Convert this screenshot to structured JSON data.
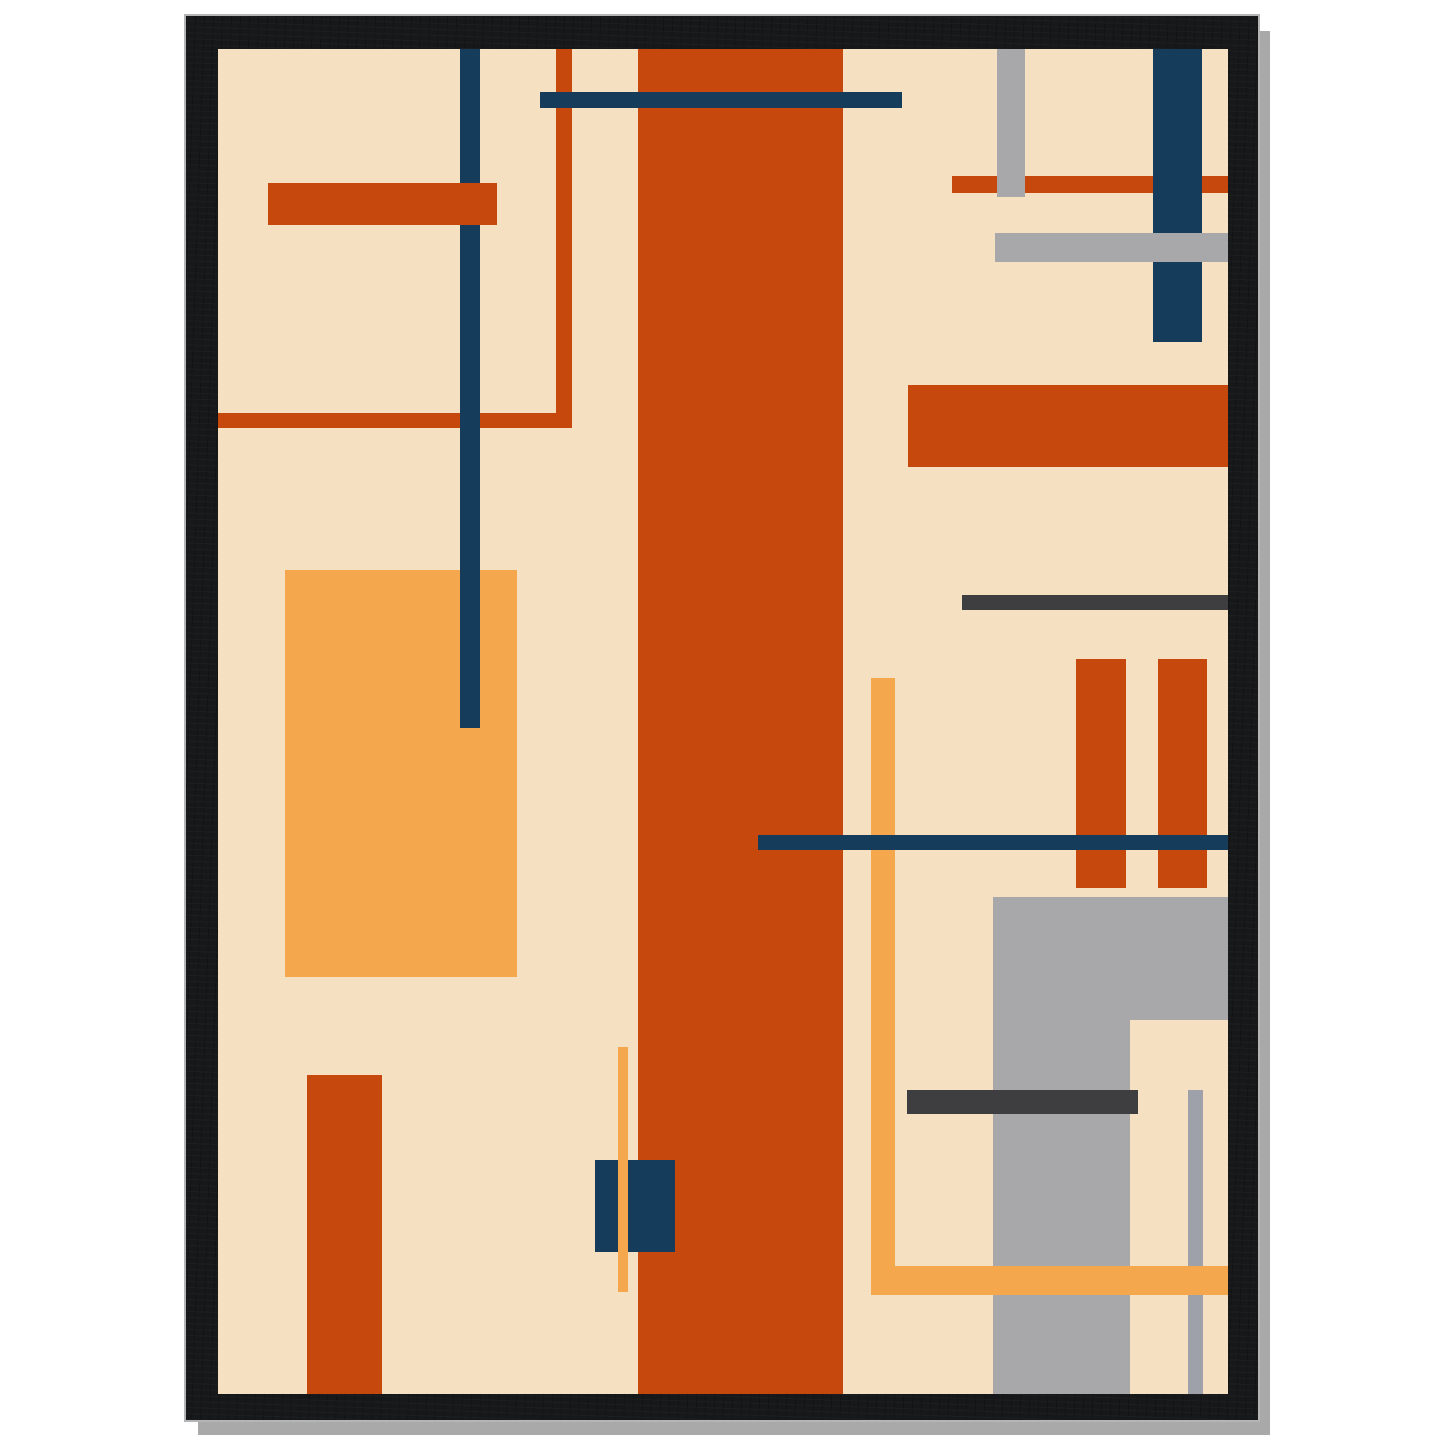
{
  "scene": {
    "background": "#ffffff",
    "description": "framed abstract geometric art poster mockup"
  },
  "palette": {
    "cream": "#F5E1C1",
    "rust": "#C6480D",
    "amber": "#F5A74D",
    "navy": "#163C5C",
    "gray": "#A8A8AA",
    "darkgray": "#3E3E40",
    "linegray": "#9EA1A9",
    "frame_black": "#17181A",
    "shadow_gray": "#A9A9A9",
    "outline_gray": "#B5B5B5"
  },
  "frame": {
    "x": 186,
    "y": 16,
    "width": 1072,
    "height": 1404,
    "border_top": 33,
    "border_right": 30,
    "border_bottom": 26,
    "border_left": 32,
    "shadow_offset_x": 12,
    "shadow_offset_y": 15
  },
  "art": {
    "width": 1010,
    "height": 1345,
    "background_color_key": "cream"
  },
  "shapes": [
    {
      "name": "amber-rect-left",
      "x": 67,
      "y": 521,
      "w": 232,
      "h": 407,
      "color": "amber",
      "z": 1
    },
    {
      "name": "rust-line-left-horizontal",
      "x": 0,
      "y": 364,
      "w": 354,
      "h": 15,
      "color": "rust",
      "z": 1
    },
    {
      "name": "rust-line-left-vertical",
      "x": 338,
      "y": 0,
      "w": 16,
      "h": 379,
      "color": "rust",
      "z": 1
    },
    {
      "name": "rust-stripe-center",
      "x": 420,
      "y": 0,
      "w": 205,
      "h": 1345,
      "color": "rust",
      "z": 1
    },
    {
      "name": "rust-rect-bottom-left",
      "x": 89,
      "y": 1026,
      "w": 75,
      "h": 319,
      "color": "rust",
      "z": 1
    },
    {
      "name": "rust-line-top-right",
      "x": 734,
      "y": 127,
      "w": 276,
      "h": 17,
      "color": "rust",
      "z": 1
    },
    {
      "name": "rust-bar-right",
      "x": 690,
      "y": 336,
      "w": 320,
      "h": 82,
      "color": "rust",
      "z": 1
    },
    {
      "name": "darkgray-line-right",
      "x": 744,
      "y": 546,
      "w": 266,
      "h": 15,
      "color": "darkgray",
      "z": 1
    },
    {
      "name": "gray-rect-bottom-right",
      "x": 775,
      "y": 848,
      "w": 235,
      "h": 497,
      "color": "gray",
      "z": 1
    },
    {
      "name": "cream-notch-bottom-right",
      "x": 912,
      "y": 971,
      "w": 98,
      "h": 374,
      "color": "cream",
      "z": 2
    },
    {
      "name": "navy-line-left-vertical",
      "x": 242,
      "y": 0,
      "w": 20,
      "h": 679,
      "color": "navy",
      "z": 2
    },
    {
      "name": "gray-bar-top-right-vertical",
      "x": 779,
      "y": 0,
      "w": 28,
      "h": 148,
      "color": "gray",
      "z": 2
    },
    {
      "name": "rust-bar-right-pair-1",
      "x": 858,
      "y": 610,
      "w": 50,
      "h": 229,
      "color": "rust",
      "z": 2
    },
    {
      "name": "rust-bar-right-pair-2",
      "x": 940,
      "y": 610,
      "w": 49,
      "h": 229,
      "color": "rust",
      "z": 2
    },
    {
      "name": "rust-bar-top-left",
      "x": 50,
      "y": 134,
      "w": 229,
      "h": 42,
      "color": "rust",
      "z": 3
    },
    {
      "name": "navy-bar-top-right-vertical",
      "x": 935,
      "y": 0,
      "w": 49,
      "h": 293,
      "color": "navy",
      "z": 3
    },
    {
      "name": "navy-square-bottom-center",
      "x": 377,
      "y": 1111,
      "w": 80,
      "h": 92,
      "color": "navy",
      "z": 3
    },
    {
      "name": "gray-line-bottom-right-vertical",
      "x": 970,
      "y": 1041,
      "w": 15,
      "h": 304,
      "color": "linegray",
      "z": 3
    },
    {
      "name": "darkgray-bar-bottom-right",
      "x": 689,
      "y": 1041,
      "w": 231,
      "h": 24,
      "color": "darkgray",
      "z": 3
    },
    {
      "name": "gray-bar-top-right-horizontal",
      "x": 777,
      "y": 184,
      "w": 233,
      "h": 29,
      "color": "gray",
      "z": 4
    },
    {
      "name": "amber-line-bottom-center",
      "x": 400,
      "y": 998,
      "w": 10,
      "h": 245,
      "color": "amber",
      "z": 4
    },
    {
      "name": "amber-line-right-vertical",
      "x": 653,
      "y": 629,
      "w": 24,
      "h": 617,
      "color": "amber",
      "z": 4
    },
    {
      "name": "amber-bar-bottom-right-horizontal",
      "x": 653,
      "y": 1217,
      "w": 357,
      "h": 29,
      "color": "amber",
      "z": 4
    },
    {
      "name": "navy-bar-top",
      "x": 322,
      "y": 43,
      "w": 362,
      "h": 16,
      "color": "navy",
      "z": 5
    },
    {
      "name": "navy-line-right-horizontal",
      "x": 540,
      "y": 786,
      "w": 470,
      "h": 15,
      "color": "navy",
      "z": 6
    }
  ]
}
